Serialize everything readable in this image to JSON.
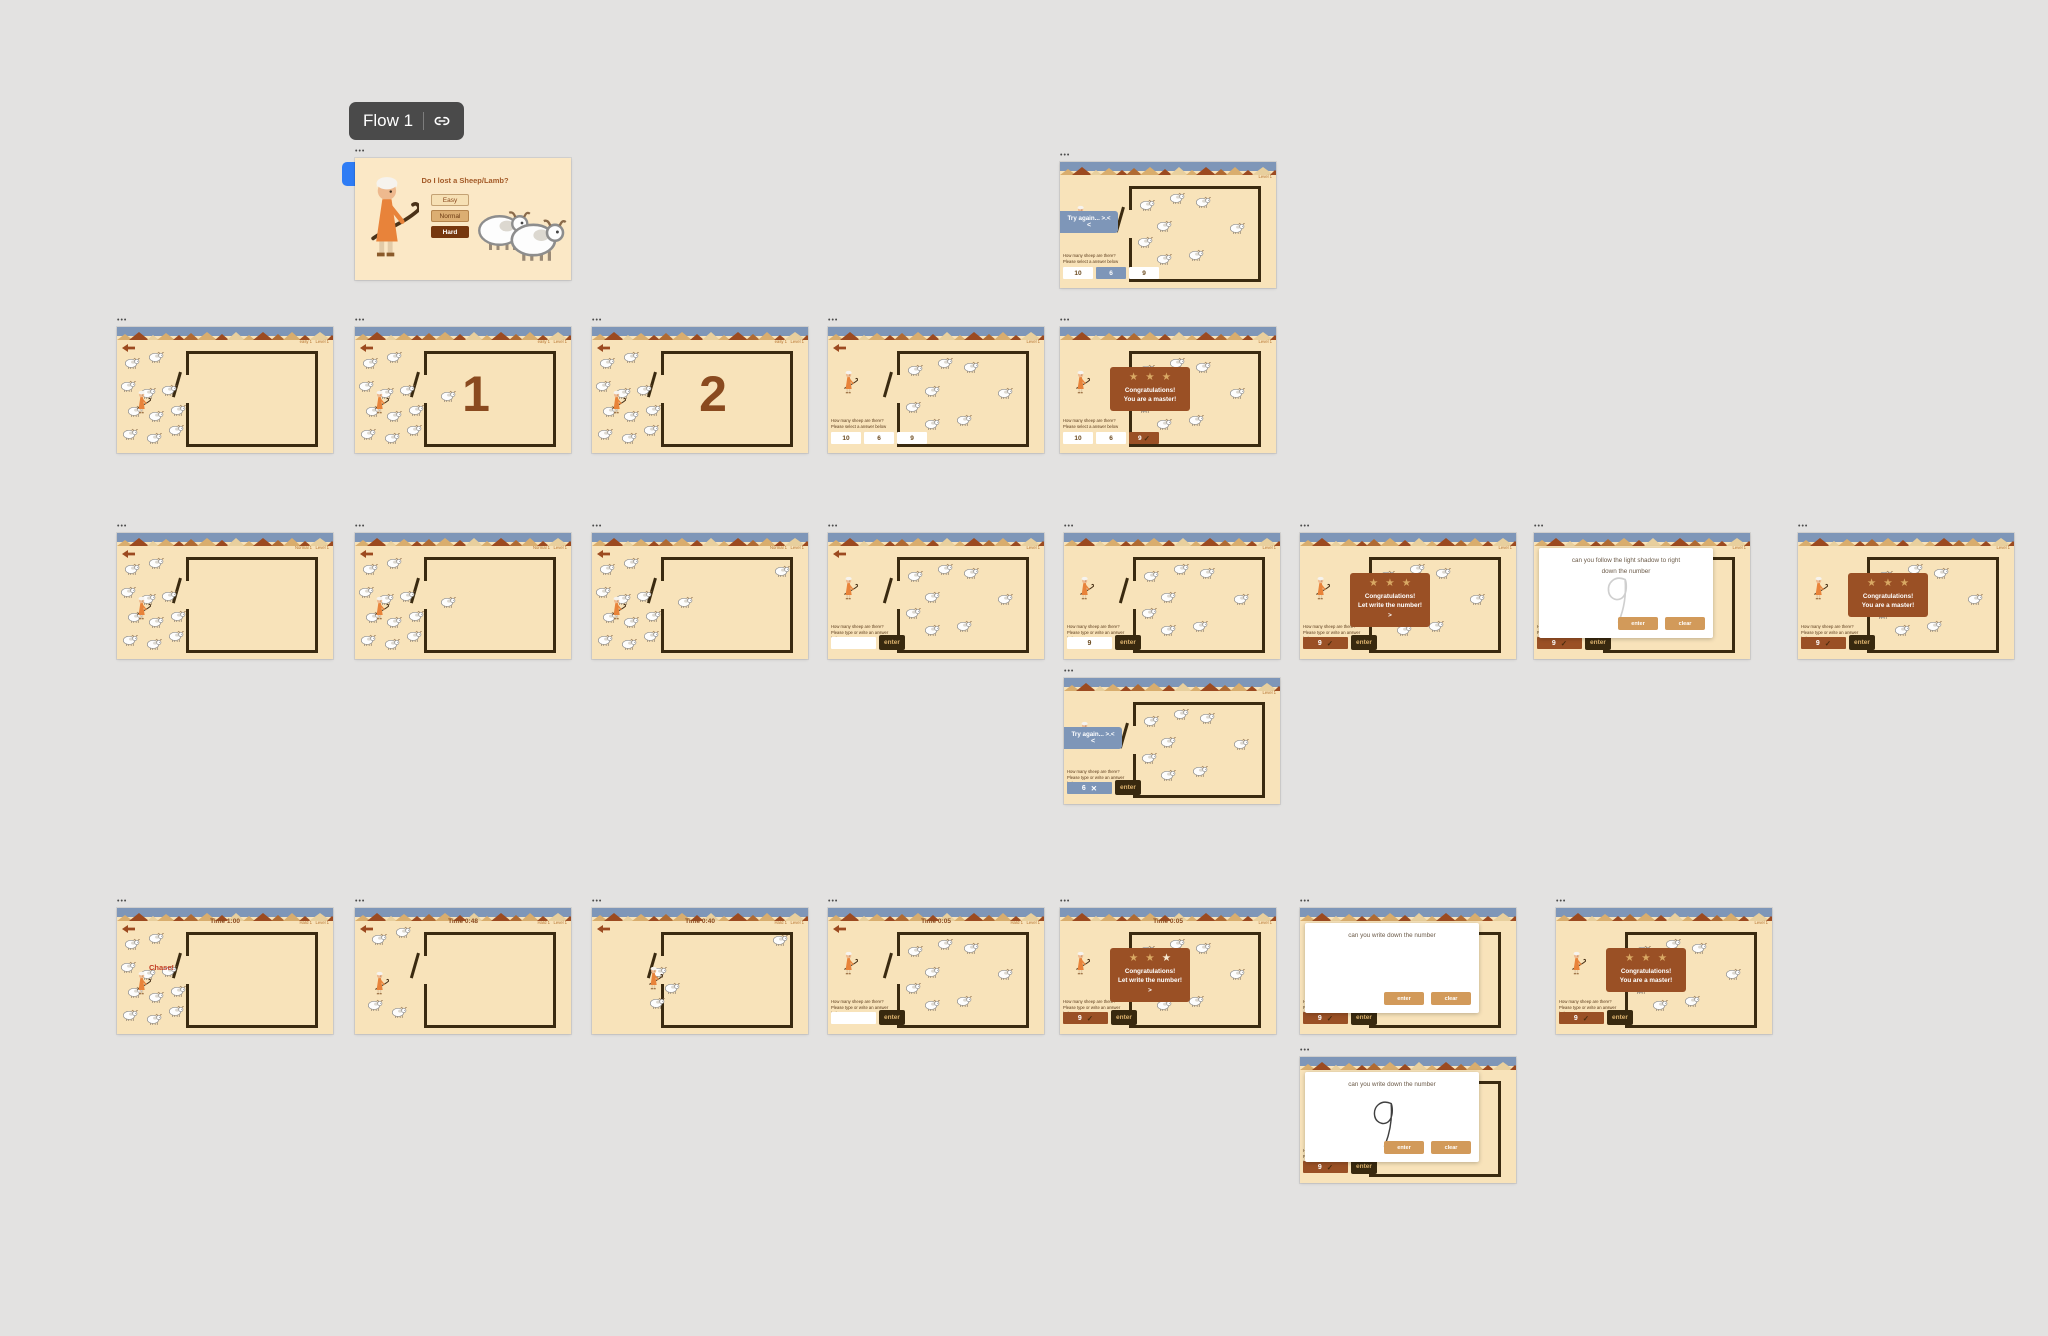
{
  "app": {
    "canvas_bg": "#e3e2e1"
  },
  "flow": {
    "label": "Flow 1"
  },
  "frame_label": "•••",
  "colors": {
    "screen_bg": "#f8e3ba",
    "intro_bg": "#fbe8c6",
    "topbar": "#7e96b8",
    "fence": "#3a2a10",
    "brown_text": "#8a4a1f",
    "overlay": "#9a5025",
    "star": "#d9a964",
    "star_bright": "#f7ead2",
    "banner": "#7e96b8",
    "enter_bg": "#38290f",
    "enter_text": "#dcb26e",
    "modal_btn": "#d29a5a",
    "chase": "#c23b22",
    "corner_text": "#b5722e",
    "marker": "#2e7cf5",
    "mountain1": "#d9ad6d",
    "mountain2": "#9c4a20",
    "mountain3": "#e8cf9d",
    "mountain4": "#b06a32"
  },
  "strings": {
    "q_select": [
      "How many sheep are there?",
      "Please select a answer below"
    ],
    "q_write": [
      "How many sheep are there?",
      "Please type or write an answer",
      "below"
    ],
    "tryagain": [
      "Try again... >.<",
      "<"
    ],
    "congrats_master": [
      "Congratulations!",
      "You are a master!"
    ],
    "congrats_write": [
      "Congratulations!",
      "Let write the number!",
      ">"
    ],
    "enter": "enter",
    "chase": "Chase!",
    "modal_follow": [
      "can you follow the light shadow to right",
      "down the number"
    ],
    "modal_write": [
      "can you write down the number"
    ],
    "modal_buttons": [
      "enter",
      "clear"
    ]
  },
  "intro": {
    "title": "Do I lost a Sheep/Lamb?",
    "buttons": [
      {
        "label": "Easy",
        "bg": "#f6e0b4",
        "fg": "#8a4a1f"
      },
      {
        "label": "Normal",
        "bg": "#dcae72",
        "fg": "#6b3a12"
      },
      {
        "label": "Hard",
        "bg": "#76370e",
        "fg": "#ffffff"
      }
    ]
  },
  "sheep_sets": {
    "flock": [
      [
        3,
        24
      ],
      [
        14,
        19
      ],
      [
        1,
        42
      ],
      [
        10,
        48
      ],
      [
        20,
        45
      ],
      [
        4,
        62
      ],
      [
        14,
        66
      ],
      [
        24,
        61
      ],
      [
        2,
        80
      ],
      [
        13,
        83
      ],
      [
        23,
        77
      ]
    ],
    "inside8": [
      [
        36,
        29
      ],
      [
        50,
        24
      ],
      [
        62,
        27
      ],
      [
        44,
        46
      ],
      [
        35,
        59
      ],
      [
        44,
        72
      ],
      [
        59,
        69
      ],
      [
        78,
        48
      ]
    ],
    "small4": [
      [
        7,
        20
      ],
      [
        18,
        14
      ],
      [
        5,
        72
      ],
      [
        16,
        78
      ]
    ],
    "mid4": [
      [
        27,
        46
      ],
      [
        33,
        59
      ],
      [
        26,
        71
      ],
      [
        83,
        21
      ]
    ],
    "gate1": [
      [
        39,
        50
      ]
    ],
    "gate2": [
      [
        39,
        50
      ],
      [
        84,
        25
      ]
    ]
  },
  "screens": [
    {
      "name": "intro-screen",
      "kind": "intro",
      "x": 355,
      "y": 158,
      "w": 216,
      "h": 122,
      "flow_start": true
    },
    {
      "name": "easy-try-again-screen",
      "x": 1060,
      "y": 162,
      "w": 216,
      "h": 126,
      "corner": "Level 1",
      "fence": true,
      "inside": "inside8",
      "shepherd": [
        7,
        34
      ],
      "q": "q_select",
      "options": [
        {
          "v": "10",
          "s": "white"
        },
        {
          "v": "6",
          "s": "blue"
        },
        {
          "v": "9",
          "s": "white"
        }
      ],
      "overlay": "tryagain"
    },
    {
      "name": "easy-herding-empty-screen",
      "x": 117,
      "y": 327,
      "w": 216,
      "h": 126,
      "corner": "easy 1   Level 1",
      "back": true,
      "fence": true,
      "outside": "flock",
      "shepherd": [
        9,
        50
      ]
    },
    {
      "name": "easy-count-1-screen",
      "x": 355,
      "y": 327,
      "w": 216,
      "h": 126,
      "corner": "easy 1   Level 1",
      "back": true,
      "fence": true,
      "fence_number": "1",
      "outside": "flock",
      "extra": "gate1",
      "shepherd": [
        9,
        50
      ]
    },
    {
      "name": "easy-count-2-screen",
      "x": 592,
      "y": 327,
      "w": 216,
      "h": 126,
      "corner": "easy 1   Level 1",
      "back": true,
      "fence": true,
      "fence_number": "2",
      "outside": "flock",
      "shepherd": [
        9,
        50
      ]
    },
    {
      "name": "easy-question-screen",
      "x": 828,
      "y": 327,
      "w": 216,
      "h": 126,
      "corner": "Level 1",
      "back": true,
      "fence": true,
      "inside": "inside8",
      "shepherd": [
        7,
        34
      ],
      "q": "q_select",
      "options": [
        {
          "v": "10",
          "s": "white"
        },
        {
          "v": "6",
          "s": "white"
        },
        {
          "v": "9",
          "s": "white"
        }
      ]
    },
    {
      "name": "easy-congrats-screen",
      "x": 1060,
      "y": 327,
      "w": 216,
      "h": 126,
      "corner": "Level 1",
      "fence": true,
      "inside": "inside8",
      "shepherd": [
        7,
        34
      ],
      "q": "q_select",
      "options": [
        {
          "v": "10",
          "s": "white"
        },
        {
          "v": "6",
          "s": "white"
        },
        {
          "v": "9",
          "s": "brown",
          "mark": "check"
        }
      ],
      "overlay": "congrats_master",
      "stars": [
        "star",
        "star",
        "star"
      ]
    },
    {
      "name": "normal-herding-empty-screen",
      "x": 117,
      "y": 533,
      "w": 216,
      "h": 126,
      "corner": "Normal 1   Level 1",
      "back": true,
      "fence": true,
      "outside": "flock",
      "shepherd": [
        9,
        50
      ]
    },
    {
      "name": "normal-herding-1-screen",
      "x": 355,
      "y": 533,
      "w": 216,
      "h": 126,
      "corner": "Normal 1   Level 1",
      "back": true,
      "fence": true,
      "outside": "flock",
      "inside": "gate1",
      "shepherd": [
        9,
        50
      ]
    },
    {
      "name": "normal-herding-2-screen",
      "x": 592,
      "y": 533,
      "w": 216,
      "h": 126,
      "corner": "Normal 1   Level 1",
      "back": true,
      "fence": true,
      "outside": "flock",
      "inside": "gate2",
      "shepherd": [
        9,
        50
      ]
    },
    {
      "name": "normal-question-screen",
      "x": 828,
      "y": 533,
      "w": 216,
      "h": 126,
      "corner": "Level 1",
      "back": true,
      "fence": true,
      "inside": "inside8",
      "shepherd": [
        7,
        34
      ],
      "q": "q_write",
      "input": {
        "v": "",
        "s": "white"
      },
      "enter": true
    },
    {
      "name": "normal-answer-screen",
      "x": 1064,
      "y": 533,
      "w": 216,
      "h": 126,
      "corner": "Level 1",
      "fence": true,
      "inside": "inside8",
      "shepherd": [
        7,
        34
      ],
      "q": "q_write",
      "input": {
        "v": "9",
        "s": "white"
      },
      "enter": true
    },
    {
      "name": "normal-congrats-write-screen",
      "x": 1300,
      "y": 533,
      "w": 216,
      "h": 126,
      "corner": "Level 1",
      "fence": true,
      "inside": "inside8",
      "shepherd": [
        7,
        34
      ],
      "q": "q_write",
      "overlay": "congrats_write",
      "stars": [
        "star",
        "star",
        "star"
      ],
      "input": {
        "v": "9",
        "s": "brown",
        "mark": "check"
      },
      "enter": true
    },
    {
      "name": "trace-number-screen",
      "x": 1534,
      "y": 533,
      "w": 216,
      "h": 126,
      "corner": "Level 1",
      "fence": true,
      "q": "q_write",
      "input": {
        "v": "9",
        "s": "brown",
        "mark": "check"
      },
      "enter": true,
      "modal": {
        "lines": "modal_follow",
        "digit": "shadow",
        "buttons": true
      }
    },
    {
      "name": "normal-congrats-screen",
      "x": 1798,
      "y": 533,
      "w": 216,
      "h": 126,
      "corner": "Level 1",
      "fence": true,
      "inside": "inside8",
      "shepherd": [
        7,
        34
      ],
      "q": "q_write",
      "overlay": "congrats_master",
      "stars": [
        "star",
        "star",
        "star"
      ],
      "input": {
        "v": "9",
        "s": "brown",
        "mark": "check"
      },
      "enter": true
    },
    {
      "name": "normal-try-again-screen",
      "x": 1064,
      "y": 678,
      "w": 216,
      "h": 126,
      "corner": "Level 1",
      "fence": true,
      "inside": "inside8",
      "shepherd": [
        7,
        34
      ],
      "q": "q_write",
      "overlay": "tryagain",
      "input": {
        "v": "6",
        "s": "blue",
        "mark": "cross"
      },
      "enter": true
    },
    {
      "name": "hard-herding-empty-screen",
      "x": 117,
      "y": 908,
      "w": 216,
      "h": 126,
      "timer": "Time 1:00",
      "corner": "Hard 1   Level 1",
      "back": true,
      "fence": true,
      "outside": "flock",
      "shepherd": [
        9,
        50
      ],
      "chase": true
    },
    {
      "name": "hard-herding-2-screen",
      "x": 355,
      "y": 908,
      "w": 216,
      "h": 126,
      "timer": "Time 0:48",
      "corner": "Hard 1   Level 1",
      "back": true,
      "fence": true,
      "outside": "small4",
      "shepherd": [
        9,
        50
      ]
    },
    {
      "name": "hard-herding-3-screen",
      "x": 592,
      "y": 908,
      "w": 216,
      "h": 126,
      "timer": "Time 0:40",
      "corner": "Hard 1   Level 1",
      "back": true,
      "fence": true,
      "outside": "mid4",
      "shepherd": [
        26,
        46
      ]
    },
    {
      "name": "hard-question-screen",
      "x": 828,
      "y": 908,
      "w": 216,
      "h": 126,
      "timer": "Time 0:05",
      "corner": "Hard 1   Level 1",
      "back": true,
      "fence": true,
      "inside": "inside8",
      "shepherd": [
        7,
        34
      ],
      "q": "q_write",
      "input": {
        "v": "",
        "s": "white"
      },
      "enter": true
    },
    {
      "name": "hard-congrats-write-screen",
      "x": 1060,
      "y": 908,
      "w": 216,
      "h": 126,
      "timer": "Time 0:05",
      "corner": "Level 1",
      "fence": true,
      "inside": "inside8",
      "shepherd": [
        7,
        34
      ],
      "q": "q_write",
      "overlay": "congrats_write",
      "stars": [
        "star",
        "star",
        "star_bright"
      ],
      "input": {
        "v": "9",
        "s": "brown",
        "mark": "check"
      },
      "enter": true
    },
    {
      "name": "write-number-blank-screen",
      "x": 1300,
      "y": 908,
      "w": 216,
      "h": 126,
      "fence": true,
      "q": "q_write",
      "input": {
        "v": "9",
        "s": "brown",
        "mark": "check"
      },
      "enter": true,
      "modal": {
        "lines": "modal_write",
        "digit": null,
        "buttons": true
      }
    },
    {
      "name": "hard-congrats-screen",
      "x": 1556,
      "y": 908,
      "w": 216,
      "h": 126,
      "corner": "Level 1",
      "fence": true,
      "inside": "inside8",
      "shepherd": [
        7,
        34
      ],
      "q": "q_write",
      "overlay": "congrats_master",
      "stars": [
        "star",
        "star",
        "star"
      ],
      "input": {
        "v": "9",
        "s": "brown",
        "mark": "check"
      },
      "enter": true
    },
    {
      "name": "write-number-done-screen",
      "x": 1300,
      "y": 1057,
      "w": 216,
      "h": 126,
      "fence": true,
      "q": "q_write",
      "input": {
        "v": "9",
        "s": "brown",
        "mark": "check"
      },
      "enter": true,
      "modal": {
        "lines": "modal_write",
        "digit": "ink",
        "buttons": true
      }
    }
  ]
}
